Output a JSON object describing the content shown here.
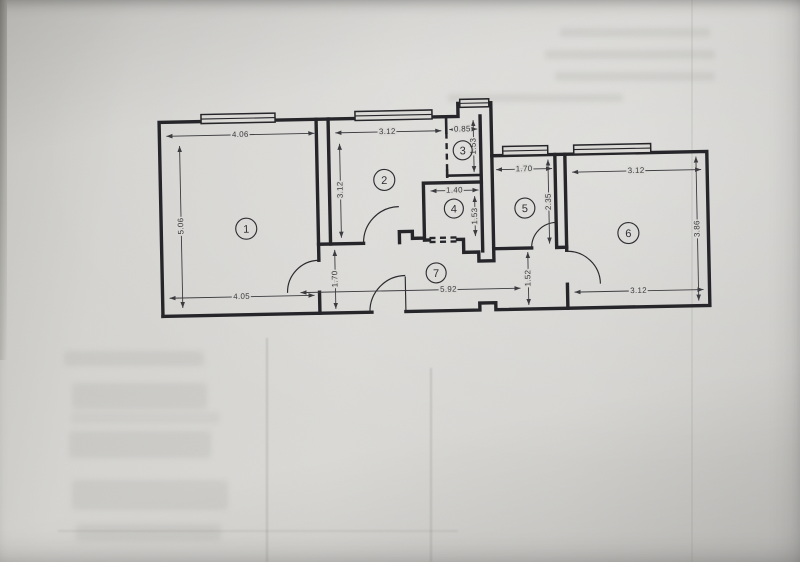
{
  "document": {
    "kind": "photographed architectural floor plan",
    "unit": "m"
  },
  "colors": {
    "paper": "#d7d6d3",
    "ink": "#26262a",
    "dim_text": "#3a3a3e"
  },
  "plan": {
    "rooms": [
      {
        "number": "1",
        "dims": {
          "top": "4.06",
          "left": "5.06",
          "bottom": "4.05"
        }
      },
      {
        "number": "2",
        "dims": {
          "top": "3.12",
          "left": "3.12"
        }
      },
      {
        "number": "3",
        "dims": {
          "top": "0.85",
          "right": "1.53"
        }
      },
      {
        "number": "4",
        "dims": {
          "top": "1.40",
          "right": "1.53"
        }
      },
      {
        "number": "5",
        "dims": {
          "top": "1.70",
          "right": "2.35"
        }
      },
      {
        "number": "6",
        "dims": {
          "top": "3.12",
          "right": "3.86",
          "bottom": "3.12"
        }
      },
      {
        "number": "7",
        "dims": {
          "length": "5.92",
          "left": "1.70",
          "right": "1.52"
        }
      }
    ]
  }
}
